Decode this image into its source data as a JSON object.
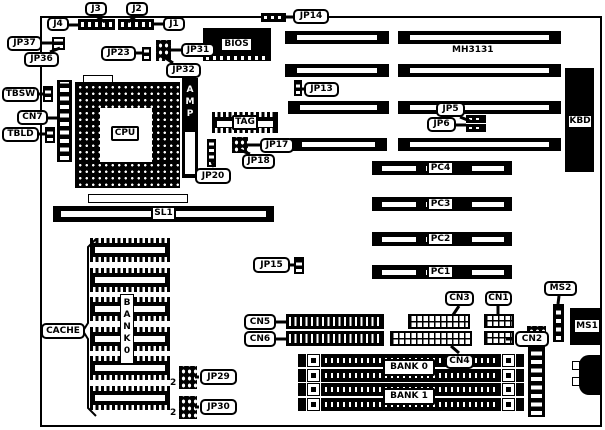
{
  "chips": {
    "cpu": "CPU",
    "bios": "BIOS",
    "tag": "TAG",
    "amp": "AMP",
    "cache": "CACHE",
    "cache_bank_vertical": "BANK0",
    "chipset": "MH3131",
    "kbd": "KBD"
  },
  "slots": {
    "sl1": "SL1",
    "pc1": "PC1",
    "pc2": "PC2",
    "pc3": "PC3",
    "pc4": "PC4",
    "bank0": "BANK 0",
    "bank1": "BANK 1"
  },
  "jumpers": {
    "jp5": "JP5",
    "jp6": "JP6",
    "jp13": "JP13",
    "jp14": "JP14",
    "jp15": "JP15",
    "jp17": "JP17",
    "jp18": "JP18",
    "jp20": "JP20",
    "jp23": "JP23",
    "jp29": "JP29",
    "jp30": "JP30",
    "jp31": "JP31",
    "jp32": "JP32",
    "jp36": "JP36",
    "jp37": "JP37"
  },
  "connectors": {
    "j1": "J1",
    "j2": "J2",
    "j3": "J3",
    "j4": "J4",
    "cn1": "CN1",
    "cn2": "CN2",
    "cn3": "CN3",
    "cn4": "CN4",
    "cn5": "CN5",
    "cn6": "CN6",
    "cn7": "CN7",
    "ms1": "MS1",
    "ms2": "MS2",
    "tbsw": "TBSW",
    "tbld": "TBLD"
  },
  "pin_markers": {
    "jp29_pin1": "2",
    "jp30_pin1": "2"
  }
}
